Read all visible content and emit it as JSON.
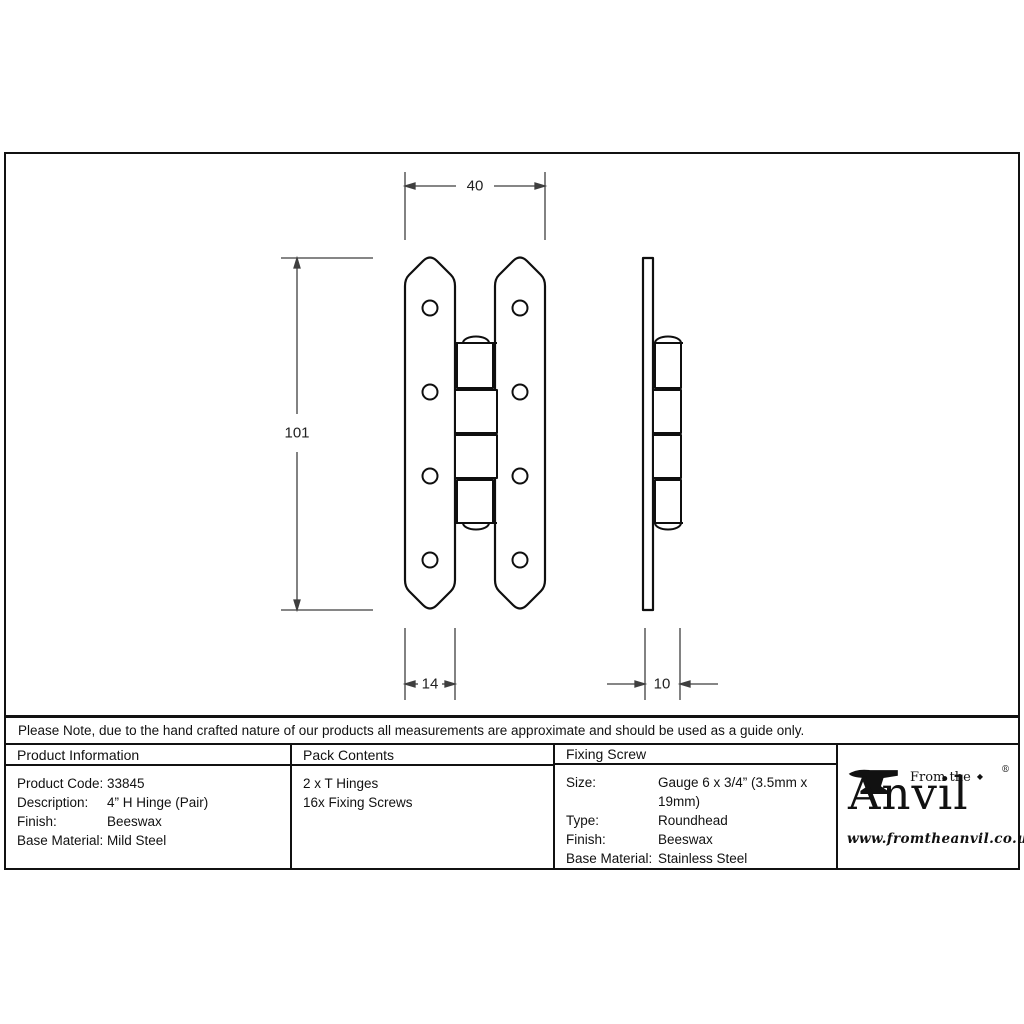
{
  "note": "Please Note, due to the hand crafted nature of our products all measurements are approximate and should be used as a guide only.",
  "drawing": {
    "dim_width": "40",
    "dim_height": "101",
    "dim_leaf_width": "14",
    "dim_depth": "10"
  },
  "product_info": {
    "header": "Product Information",
    "rows": [
      {
        "label": "Product Code:",
        "value": "33845"
      },
      {
        "label": "Description:",
        "value": "4” H Hinge (Pair)"
      },
      {
        "label": "Finish:",
        "value": "Beeswax"
      },
      {
        "label": "Base Material:",
        "value": "Mild Steel"
      }
    ]
  },
  "pack_contents": {
    "header": "Pack Contents",
    "lines": [
      "2 x T Hinges",
      "16x Fixing Screws"
    ]
  },
  "fixing_screw": {
    "header": "Fixing Screw",
    "rows": [
      {
        "label": "Size:",
        "value": "Gauge 6 x 3/4” (3.5mm x 19mm)"
      },
      {
        "label": "Type:",
        "value": "Roundhead"
      },
      {
        "label": "Finish:",
        "value": "Beeswax"
      },
      {
        "label": "Base Material:",
        "value": "Stainless Steel"
      }
    ]
  },
  "logo": {
    "prefix": "From the",
    "brand": "Anvil",
    "diamond": "◆",
    "registered": "®",
    "website": "www.fromtheanvil.co.uk"
  },
  "colors": {
    "object_line": "#0f0f0f",
    "dimension_line": "#3f3f3f",
    "border": "#111111"
  }
}
